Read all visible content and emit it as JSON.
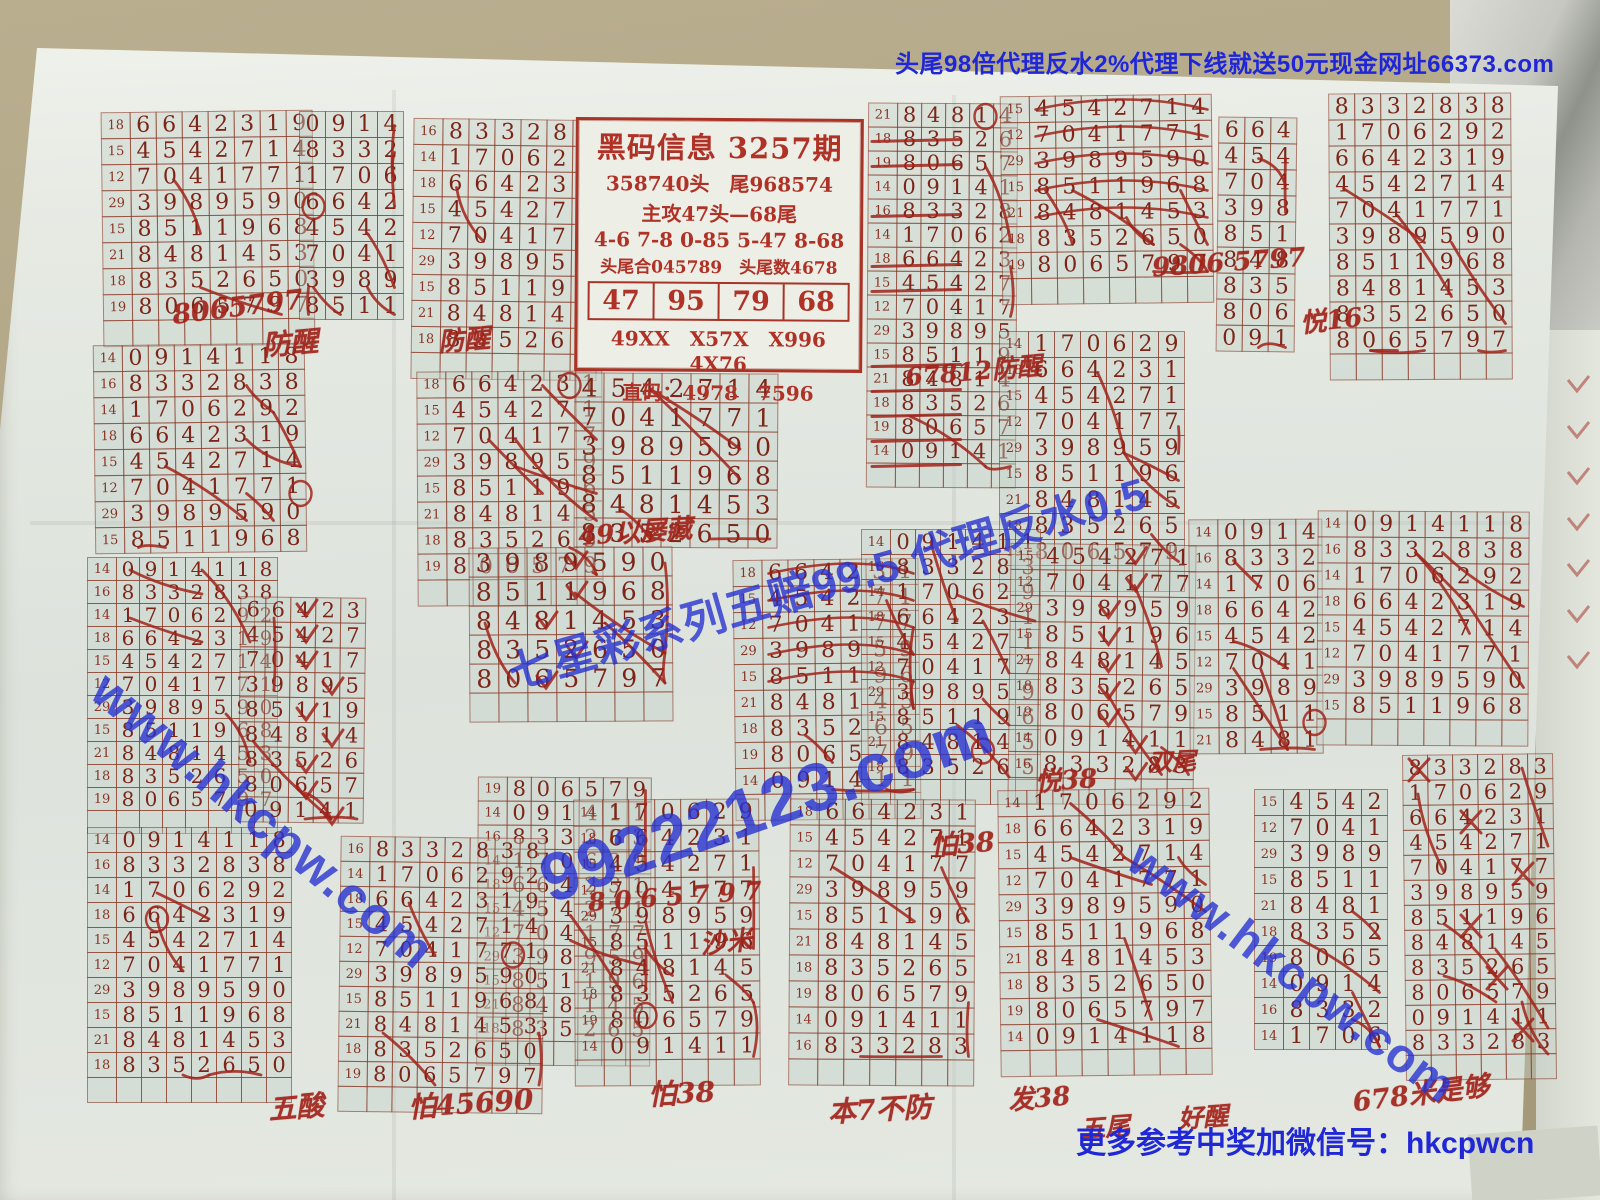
{
  "banners": {
    "top": "头尾98倍代理反水2%代理下线就送50元现金网址66373.com",
    "bottom": "更多参考中奖加微信号：hkcpwcn"
  },
  "info": {
    "title": "黑码信息 3257期",
    "line_heads": "358740头　尾968574",
    "line_attack": "主攻47头—68尾",
    "line_pairs": "4-6  7-8  0-85  5-47  8-68",
    "line_sum": "头尾合045789　头尾数4678",
    "boxed": [
      "47",
      "95",
      "79",
      "68"
    ],
    "line_codes": "49XX　X57X　X996　4X76",
    "line_direct": "直码：4978　7596"
  },
  "draws": [
    {
      "label": "14",
      "digits": "0914118"
    },
    {
      "label": "16",
      "digits": "8332838"
    },
    {
      "label": "14",
      "digits": "1706292"
    },
    {
      "label": "18",
      "digits": "6642319"
    },
    {
      "label": "15",
      "digits": "4542714"
    },
    {
      "label": "12",
      "digits": "7041771"
    },
    {
      "label": "29",
      "digits": "3989590"
    },
    {
      "label": "15",
      "digits": "8511968"
    },
    {
      "label": "21",
      "digits": "8481453"
    },
    {
      "label": "18",
      "digits": "8352650"
    },
    {
      "label": "19",
      "digits": "8065797"
    }
  ],
  "blocks": [
    {
      "x": 103,
      "y": 112,
      "c": 7,
      "n": 8,
      "s": 3,
      "L": 1,
      "t": 1
    },
    {
      "x": 300,
      "y": 112,
      "c": 4,
      "n": 8,
      "s": 0,
      "L": 0,
      "t": 0
    },
    {
      "x": 413,
      "y": 120,
      "c": 6,
      "n": 9,
      "s": 1,
      "L": 1,
      "t": 1
    },
    {
      "x": 418,
      "y": 372,
      "c": 6,
      "n": 8,
      "s": 3,
      "L": 1,
      "t": 1
    },
    {
      "x": 868,
      "y": 104,
      "c": 5,
      "n": 15,
      "s": 8,
      "L": 1,
      "cell": 25,
      "fx": "strike",
      "t": 1
    },
    {
      "x": 1002,
      "y": 96,
      "c": 7,
      "n": 7,
      "s": 4,
      "L": 1,
      "t": 1,
      "fx": "arcs"
    },
    {
      "x": 1000,
      "y": 332,
      "c": 6,
      "n": 9,
      "s": 2,
      "L": 1,
      "t": 1
    },
    {
      "x": 1218,
      "y": 118,
      "c": 3,
      "n": 9,
      "s": 3,
      "L": 0,
      "t": 0
    },
    {
      "x": 1330,
      "y": 94,
      "c": 7,
      "n": 10,
      "s": 1,
      "L": 0,
      "t": 1
    },
    {
      "x": 575,
      "y": 374,
      "c": 7,
      "n": 6,
      "s": 4,
      "L": 0,
      "cell": 30,
      "t": 0
    },
    {
      "x": 95,
      "y": 345,
      "c": 7,
      "n": 8,
      "s": 0,
      "L": 1,
      "t": 0
    },
    {
      "x": 88,
      "y": 558,
      "c": 7,
      "n": 11,
      "s": 0,
      "L": 1,
      "cell": 24,
      "t": 1
    },
    {
      "x": 240,
      "y": 598,
      "c": 5,
      "n": 9,
      "s": 3,
      "L": 0,
      "cell": 26,
      "fx": "v",
      "t": 0
    },
    {
      "x": 470,
      "y": 548,
      "c": 7,
      "n": 5,
      "s": 6,
      "L": 0,
      "cell": 30,
      "fx": "v",
      "t": 1
    },
    {
      "x": 478,
      "y": 778,
      "c": 6,
      "n": 11,
      "s": 10,
      "L": 1,
      "cell": 25,
      "t": 1
    },
    {
      "x": 735,
      "y": 560,
      "c": 6,
      "n": 9,
      "s": 3,
      "L": 1,
      "fx": "arcs",
      "t": 1
    },
    {
      "x": 862,
      "y": 530,
      "c": 6,
      "n": 10,
      "s": 0,
      "L": 1,
      "cell": 26,
      "t": 1
    },
    {
      "x": 1010,
      "y": 545,
      "c": 6,
      "n": 9,
      "s": 4,
      "L": 1,
      "fx": "v",
      "t": 1
    },
    {
      "x": 1190,
      "y": 520,
      "c": 4,
      "n": 9,
      "s": 0,
      "L": 1,
      "t": 0
    },
    {
      "x": 1318,
      "y": 512,
      "c": 7,
      "n": 8,
      "s": 0,
      "L": 1,
      "t": 1
    },
    {
      "x": 1405,
      "y": 755,
      "c": 6,
      "n": 12,
      "s": 1,
      "L": 0,
      "cell": 26,
      "fx": "x",
      "t": 1
    },
    {
      "x": 88,
      "y": 828,
      "c": 7,
      "n": 10,
      "s": 0,
      "L": 1,
      "cell": 26,
      "t": 1
    },
    {
      "x": 340,
      "y": 838,
      "c": 7,
      "n": 10,
      "s": 1,
      "L": 1,
      "cell": 26,
      "t": 1
    },
    {
      "x": 575,
      "y": 800,
      "c": 6,
      "n": 10,
      "s": 2,
      "L": 1,
      "t": 1
    },
    {
      "x": 790,
      "y": 800,
      "c": 6,
      "n": 10,
      "s": 3,
      "L": 1,
      "t": 1
    },
    {
      "x": 1000,
      "y": 790,
      "c": 7,
      "n": 10,
      "s": 2,
      "L": 1,
      "t": 1
    },
    {
      "x": 1255,
      "y": 790,
      "c": 4,
      "n": 10,
      "s": 4,
      "L": 1,
      "t": 0
    }
  ],
  "notes": [
    {
      "text": "8065797",
      "x": 172,
      "y": 292,
      "r": -7,
      "s": 27
    },
    {
      "text": "防醒",
      "x": 262,
      "y": 322,
      "r": -5,
      "s": 28
    },
    {
      "text": "防醒",
      "x": 438,
      "y": 320,
      "r": -5,
      "s": 26
    },
    {
      "text": "9806 5797",
      "x": 1152,
      "y": 248,
      "r": -4,
      "s": 26
    },
    {
      "text": "悦16",
      "x": 1300,
      "y": 300,
      "r": -6,
      "s": 26
    },
    {
      "text": "67812防醒",
      "x": 905,
      "y": 352,
      "r": -5,
      "s": 25
    },
    {
      "text": "49以屡藏",
      "x": 578,
      "y": 512,
      "r": -4,
      "s": 26
    },
    {
      "text": "8 0 6 5 7 9 7",
      "x": 588,
      "y": 882,
      "r": -4,
      "s": 25
    },
    {
      "text": "怕38",
      "x": 930,
      "y": 822,
      "r": -4,
      "s": 27
    },
    {
      "text": "悦38",
      "x": 1035,
      "y": 760,
      "r": -4,
      "s": 26
    },
    {
      "text": "双尾",
      "x": 1148,
      "y": 742,
      "r": -2,
      "s": 24
    },
    {
      "text": "沙米",
      "x": 700,
      "y": 922,
      "r": -6,
      "s": 26
    },
    {
      "text": "五酸",
      "x": 268,
      "y": 1086,
      "r": -5,
      "s": 28
    },
    {
      "text": "怕45690",
      "x": 408,
      "y": 1082,
      "r": -4,
      "s": 28
    },
    {
      "text": "怕38",
      "x": 648,
      "y": 1072,
      "r": -3,
      "s": 28
    },
    {
      "text": "本7不防",
      "x": 828,
      "y": 1088,
      "r": -3,
      "s": 28
    },
    {
      "text": "发38",
      "x": 1008,
      "y": 1078,
      "r": -5,
      "s": 26
    },
    {
      "text": "五尾",
      "x": 1080,
      "y": 1108,
      "r": -4,
      "s": 25
    },
    {
      "text": "好醒",
      "x": 1178,
      "y": 1098,
      "r": -4,
      "s": 25
    },
    {
      "text": "678米是够",
      "x": 1352,
      "y": 1072,
      "r": -7,
      "s": 27
    }
  ],
  "watermarks": [
    {
      "text": "www.hkcpw.com",
      "x": 118,
      "y": 660,
      "r": 40,
      "s": 52
    },
    {
      "text": "99222123.com",
      "x": 530,
      "y": 845,
      "r": -19,
      "s": 68
    },
    {
      "text": "七星彩系列五赔99.5 代理反水0.5",
      "x": 500,
      "y": 640,
      "r": -16,
      "s": 44
    },
    {
      "text": "www.hkcpw.com",
      "x": 1150,
      "y": 832,
      "r": 37,
      "s": 48
    }
  ],
  "colors": {
    "paper": "#e6eae3",
    "grid_ink": "#8a3a28",
    "digit_ink": "#7c2518",
    "hand_ink": "#a1231a",
    "watermark_blue": "#2530d2",
    "banner_blue": "#1e26d8",
    "table_tan": "#b0a687"
  }
}
